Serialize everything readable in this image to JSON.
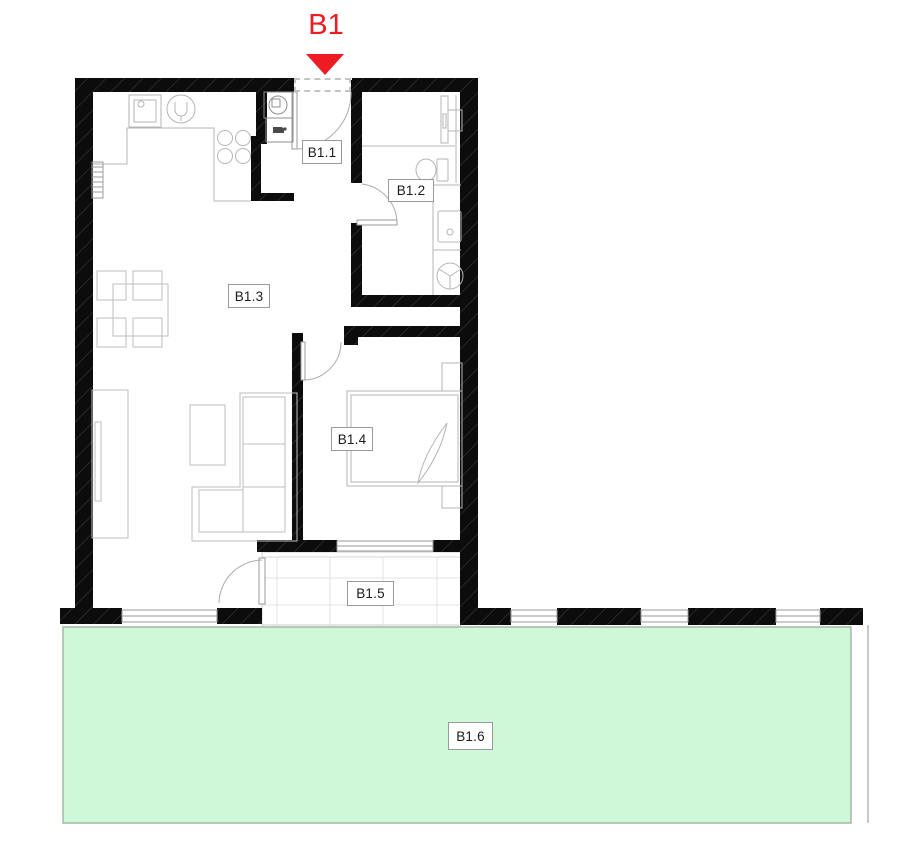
{
  "plan": {
    "entrance_marker": {
      "label": "B1",
      "icon": "down-arrow"
    },
    "rooms": [
      {
        "code": "B1.1"
      },
      {
        "code": "B1.2"
      },
      {
        "code": "B1.3"
      },
      {
        "code": "B1.4"
      },
      {
        "code": "B1.5"
      },
      {
        "code": "B1.6"
      }
    ],
    "colors": {
      "marker_red": "#ee1b22",
      "garden_green": "#cff8d8",
      "wall_black": "#0c0c0c",
      "line_gray": "#b3b3b3"
    }
  }
}
